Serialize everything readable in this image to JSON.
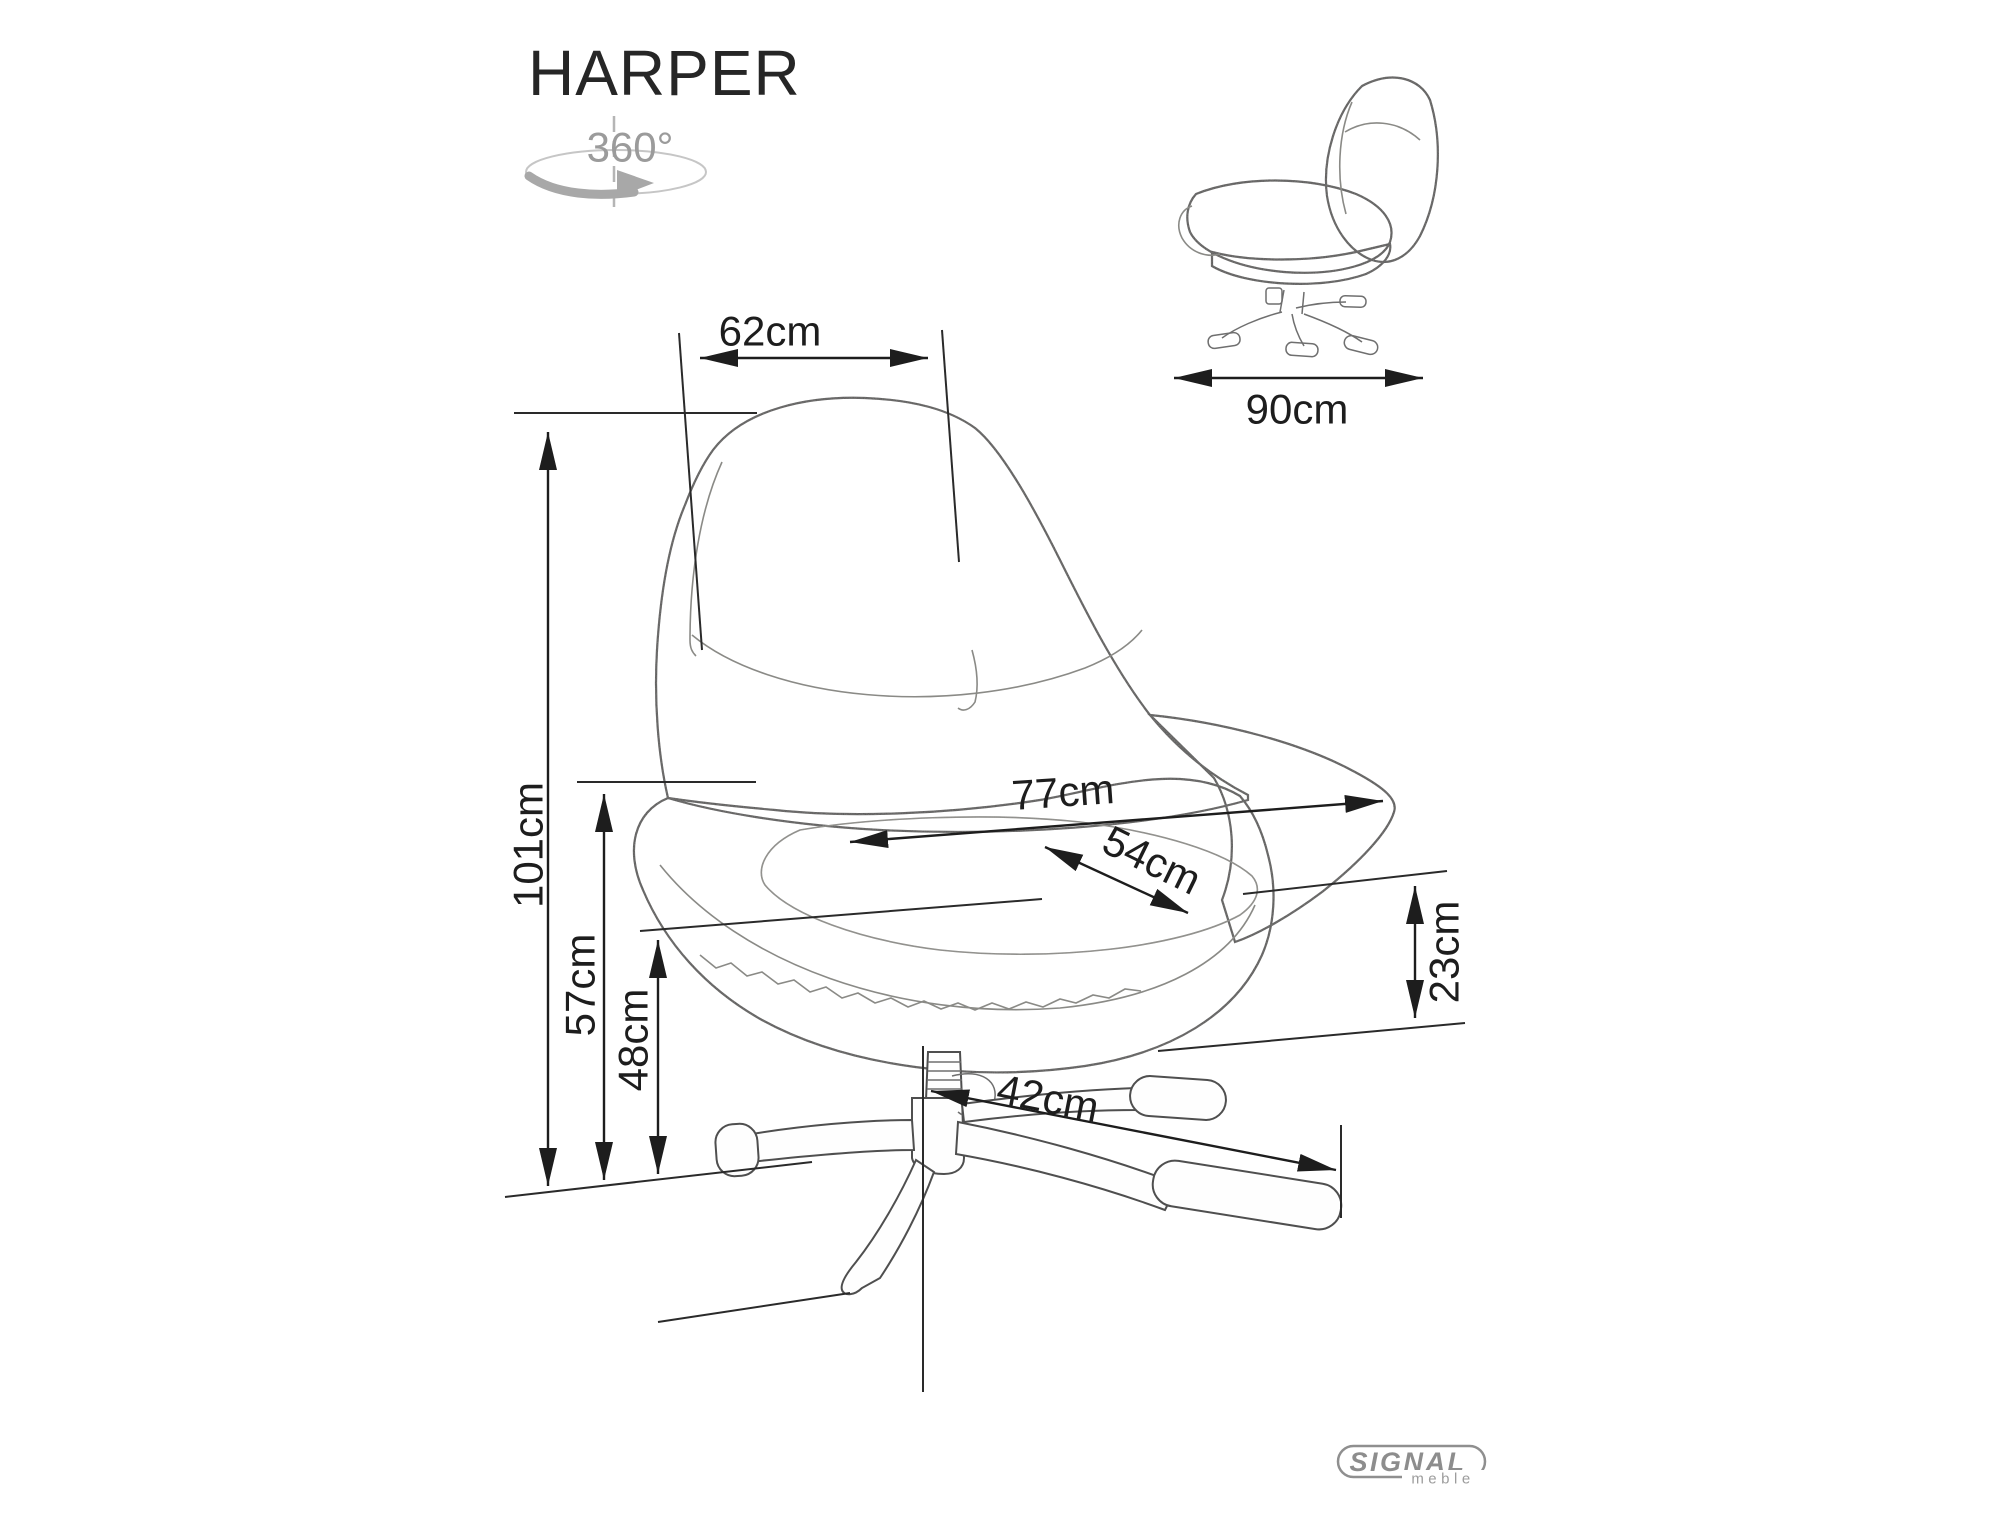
{
  "title": "HARPER",
  "rotation_icon": {
    "label": "360°"
  },
  "main_view": {
    "dimensions": {
      "back_width": "62cm",
      "total_height": "101cm",
      "total_depth": "77cm",
      "seat_width": "54cm",
      "armrest_height": "57cm",
      "seat_height": "48cm",
      "seat_thickness": "23cm",
      "base_leg_reach": "42cm"
    }
  },
  "side_view": {
    "depth": "90cm"
  },
  "logo": {
    "brand": "SIGNAL",
    "subtitle": "meble"
  },
  "colors": {
    "dimension_line": "#1d1d1d",
    "chair_outline": "#4f4f4f",
    "fabric": "#eae8e5",
    "icon_gray": "#a5a5a5",
    "logo_gray": "#8d8d8d",
    "background": "#ffffff"
  }
}
